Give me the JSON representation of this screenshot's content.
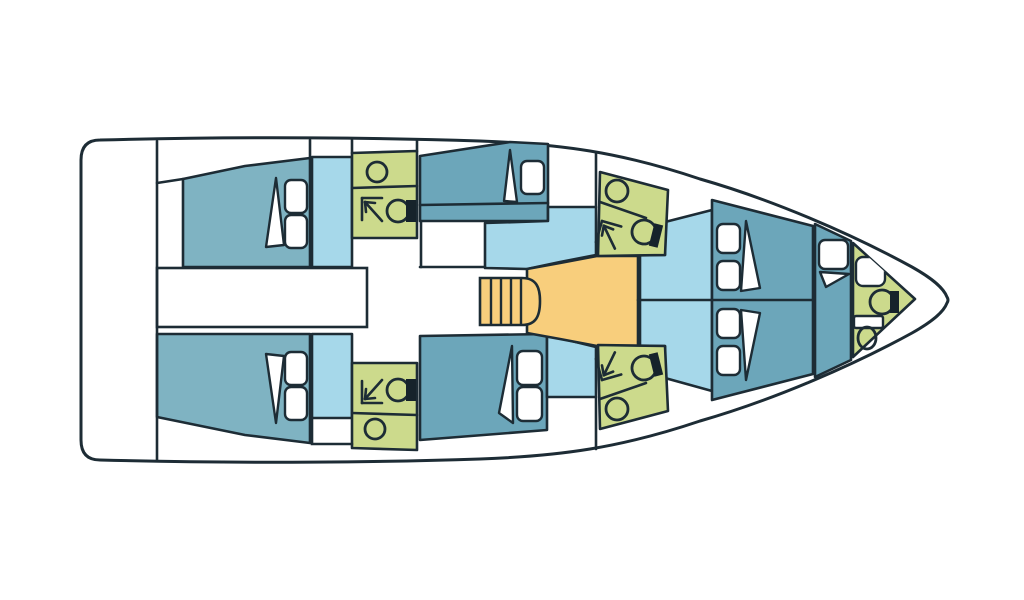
{
  "meta": {
    "canvas": {
      "width": 1024,
      "height": 600
    },
    "background": "#ffffff"
  },
  "palette": {
    "outline": "#1d2c35",
    "hull": "#ffffff",
    "cabin": "#7fb3c2",
    "berth": "#6ca6ba",
    "salon": "#a6d8ea",
    "bath": "#ccda8c",
    "galley": "#f8ce7c",
    "white": "#ffffff",
    "tank": "#16232b"
  },
  "style": {
    "hull_stroke": 3,
    "region_stroke": 2.6,
    "line_stroke": 2.6,
    "furniture_stroke": 2.4,
    "icon_stroke": 2.8,
    "pillow_radius": 6
  },
  "hull": {
    "path": "M100,140 C250,136 390,138 480,141 C560,144 620,152 700,179 C770,199 850,233 912,267 C935,280 944,289 947,297 Q949,300 947,303 C944,311 935,320 912,333 C850,367 770,401 700,421 C620,448 560,456 480,459 C390,462 250,464 100,460 Q81,460 81,440 L81,160 Q81,140 100,140 Z"
  },
  "regions": [
    {
      "name": "aft-cabin-port",
      "fill": "cabin",
      "points": [
        [
          183,
          179
        ],
        [
          245,
          166
        ],
        [
          310,
          158
        ],
        [
          310,
          267
        ],
        [
          183,
          267
        ]
      ]
    },
    {
      "name": "aft-cabin-starboard",
      "fill": "cabin",
      "points": [
        [
          157,
          334
        ],
        [
          310,
          334
        ],
        [
          310,
          443
        ],
        [
          245,
          435
        ],
        [
          157,
          417
        ]
      ]
    },
    {
      "name": "passage-port",
      "fill": "salon",
      "points": [
        [
          312,
          157
        ],
        [
          352,
          157
        ],
        [
          352,
          267
        ],
        [
          312,
          267
        ]
      ]
    },
    {
      "name": "passage-starboard",
      "fill": "salon",
      "points": [
        [
          312,
          334
        ],
        [
          352,
          334
        ],
        [
          352,
          418
        ],
        [
          312,
          418
        ]
      ]
    },
    {
      "name": "head-aft-port",
      "fill": "bath",
      "points": [
        [
          352,
          153
        ],
        [
          417,
          151
        ],
        [
          417,
          238
        ],
        [
          352,
          238
        ]
      ]
    },
    {
      "name": "head-aft-starboard",
      "fill": "bath",
      "points": [
        [
          352,
          363
        ],
        [
          417,
          363
        ],
        [
          417,
          450
        ],
        [
          352,
          448
        ]
      ]
    },
    {
      "name": "mid-cabin-port-berth",
      "fill": "berth",
      "points": [
        [
          420,
          156
        ],
        [
          510,
          142
        ],
        [
          548,
          144
        ],
        [
          548,
          221
        ],
        [
          420,
          221
        ]
      ]
    },
    {
      "name": "mid-cabin-starboard-berth",
      "fill": "berth",
      "points": [
        [
          420,
          336
        ],
        [
          547,
          334
        ],
        [
          547,
          430
        ],
        [
          420,
          440
        ]
      ]
    },
    {
      "name": "saloon-port",
      "fill": "salon",
      "points": [
        [
          485,
          223
        ],
        [
          548,
          221
        ],
        [
          548,
          207
        ],
        [
          596,
          207
        ],
        [
          596,
          255
        ],
        [
          560,
          262
        ],
        [
          527,
          269
        ],
        [
          485,
          268
        ]
      ]
    },
    {
      "name": "saloon-starboard",
      "fill": "salon",
      "points": [
        [
          547,
          335
        ],
        [
          596,
          347
        ],
        [
          596,
          397
        ],
        [
          547,
          397
        ]
      ]
    },
    {
      "name": "galley",
      "fill": "galley",
      "points": [
        [
          527,
          269
        ],
        [
          560,
          263
        ],
        [
          597,
          256
        ],
        [
          638,
          256
        ],
        [
          638,
          346
        ],
        [
          597,
          346
        ],
        [
          560,
          339
        ],
        [
          527,
          333
        ]
      ]
    },
    {
      "name": "saloon-forward",
      "fill": "salon",
      "points": [
        [
          640,
          255
        ],
        [
          665,
          255
        ],
        [
          665,
          222
        ],
        [
          712,
          210
        ],
        [
          712,
          391
        ],
        [
          665,
          378
        ],
        [
          665,
          346
        ],
        [
          640,
          346
        ]
      ]
    },
    {
      "name": "head-mid-port",
      "fill": "bath",
      "points": [
        [
          600,
          172
        ],
        [
          668,
          190
        ],
        [
          665,
          255
        ],
        [
          598,
          256
        ]
      ]
    },
    {
      "name": "head-mid-starboard",
      "fill": "bath",
      "points": [
        [
          600,
          429
        ],
        [
          668,
          411
        ],
        [
          665,
          346
        ],
        [
          598,
          345
        ]
      ]
    },
    {
      "name": "forward-cabin",
      "fill": "berth",
      "points": [
        [
          712,
          200
        ],
        [
          813,
          226
        ],
        [
          813,
          374
        ],
        [
          712,
          400
        ]
      ]
    },
    {
      "name": "bow-berth",
      "fill": "berth",
      "points": [
        [
          815,
          224
        ],
        [
          851,
          241
        ],
        [
          851,
          360
        ],
        [
          815,
          377
        ]
      ]
    },
    {
      "name": "head-bow",
      "fill": "bath",
      "points": [
        [
          853,
          243
        ],
        [
          915,
          299
        ],
        [
          853,
          357
        ]
      ]
    }
  ],
  "corridor": {
    "name": "companionway-corridor",
    "x": 157,
    "y": 268,
    "width": 210,
    "height": 59
  },
  "walls": [
    {
      "name": "transom-bulkhead",
      "points": [
        [
          157,
          141
        ],
        [
          157,
          460
        ]
      ]
    },
    {
      "name": "aft-port-cabin-edge",
      "points": [
        [
          157,
          183
        ],
        [
          183,
          179
        ]
      ]
    },
    {
      "name": "wall-port-cabin",
      "points": [
        [
          310,
          140
        ],
        [
          310,
          158
        ]
      ]
    },
    {
      "name": "wall-head-aft-port-left",
      "points": [
        [
          352,
          140
        ],
        [
          352,
          153
        ]
      ]
    },
    {
      "name": "wall-head-aft-port-right",
      "points": [
        [
          417,
          140
        ],
        [
          417,
          151
        ]
      ]
    },
    {
      "name": "corridor-extension",
      "points": [
        [
          420,
          267
        ],
        [
          485,
          267
        ]
      ]
    },
    {
      "name": "wall-mid-port",
      "points": [
        [
          421,
          221
        ],
        [
          421,
          267
        ]
      ]
    },
    {
      "name": "wall-starboard-locker",
      "points": [
        [
          312,
          418
        ],
        [
          312,
          444
        ],
        [
          352,
          444
        ]
      ]
    },
    {
      "name": "wall-port-wardrobe",
      "points": [
        [
          596,
          153
        ],
        [
          596,
          207
        ]
      ]
    },
    {
      "name": "wall-starboard-wardrobe",
      "points": [
        [
          596,
          397
        ],
        [
          596,
          449
        ]
      ]
    },
    {
      "name": "berth-shelf-divider",
      "points": [
        [
          420,
          205
        ],
        [
          548,
          203
        ]
      ]
    },
    {
      "name": "saloon-centerline",
      "points": [
        [
          638,
          300
        ],
        [
          813,
          300
        ]
      ]
    },
    {
      "name": "head-aft-port-divider",
      "points": [
        [
          352,
          188
        ],
        [
          417,
          186
        ]
      ]
    },
    {
      "name": "head-aft-starboard-divider",
      "points": [
        [
          352,
          413
        ],
        [
          417,
          415
        ]
      ]
    },
    {
      "name": "head-mid-port-divider",
      "points": [
        [
          600,
          202
        ],
        [
          646,
          218
        ]
      ]
    },
    {
      "name": "head-mid-starboard-divider",
      "points": [
        [
          600,
          399
        ],
        [
          646,
          383
        ]
      ]
    }
  ],
  "stairs": {
    "name": "companionway-stairs",
    "path": "M480,278 L522,278 C536,278 540,287 540,301 C540,316 536,325 522,325 L480,325 Z",
    "treads": [
      [
        491,
        279,
        491,
        324
      ],
      [
        501,
        279,
        501,
        324
      ],
      [
        511,
        279,
        511,
        324
      ],
      [
        521,
        279,
        521,
        324
      ]
    ]
  },
  "furniture": {
    "pillows": [
      {
        "name": "pillow",
        "x": 285,
        "y": 180,
        "w": 22,
        "h": 33
      },
      {
        "name": "pillow",
        "x": 285,
        "y": 215,
        "w": 22,
        "h": 33
      },
      {
        "name": "pillow",
        "x": 285,
        "y": 352,
        "w": 22,
        "h": 33
      },
      {
        "name": "pillow",
        "x": 285,
        "y": 387,
        "w": 22,
        "h": 33
      },
      {
        "name": "pillow",
        "x": 521,
        "y": 161,
        "w": 23,
        "h": 33
      },
      {
        "name": "pillow",
        "x": 517,
        "y": 351,
        "w": 25,
        "h": 34
      },
      {
        "name": "pillow",
        "x": 517,
        "y": 387,
        "w": 25,
        "h": 34
      },
      {
        "name": "pillow",
        "x": 717,
        "y": 224,
        "w": 23,
        "h": 29
      },
      {
        "name": "pillow",
        "x": 717,
        "y": 261,
        "w": 23,
        "h": 29
      },
      {
        "name": "pillow",
        "x": 717,
        "y": 309,
        "w": 23,
        "h": 29
      },
      {
        "name": "pillow",
        "x": 717,
        "y": 346,
        "w": 23,
        "h": 29
      },
      {
        "name": "pillow",
        "x": 819,
        "y": 240,
        "w": 29,
        "h": 29
      }
    ],
    "blankets": [
      {
        "name": "blanket-fold",
        "points": [
          [
            276,
            178
          ],
          [
            266,
            247
          ],
          [
            284,
            245
          ]
        ]
      },
      {
        "name": "blanket-fold",
        "points": [
          [
            276,
            423
          ],
          [
            266,
            354
          ],
          [
            284,
            356
          ]
        ]
      },
      {
        "name": "blanket-fold",
        "points": [
          [
            510,
            150
          ],
          [
            504,
            201
          ],
          [
            517,
            202
          ]
        ]
      },
      {
        "name": "blanket-fold",
        "points": [
          [
            512,
            346
          ],
          [
            499,
            413
          ],
          [
            513,
            423
          ]
        ]
      },
      {
        "name": "blanket-fold",
        "points": [
          [
            746,
            221
          ],
          [
            741,
            291
          ],
          [
            760,
            288
          ]
        ]
      },
      {
        "name": "blanket-fold",
        "points": [
          [
            746,
            380
          ],
          [
            741,
            310
          ],
          [
            760,
            313
          ]
        ]
      },
      {
        "name": "blanket-fold",
        "points": [
          [
            820,
            272
          ],
          [
            849,
            274
          ],
          [
            826,
            287
          ]
        ]
      }
    ],
    "sinks": [
      {
        "name": "sink",
        "cx": 377,
        "cy": 172,
        "rx": 10,
        "ry": 10
      },
      {
        "name": "sink",
        "cx": 375,
        "cy": 429,
        "rx": 10,
        "ry": 10
      },
      {
        "name": "sink",
        "cx": 617,
        "cy": 191,
        "rx": 11,
        "ry": 11
      },
      {
        "name": "sink",
        "cx": 617,
        "cy": 409,
        "rx": 11,
        "ry": 11
      },
      {
        "name": "sink",
        "cx": 867,
        "cy": 338,
        "rx": 9,
        "ry": 11
      }
    ],
    "toilets": [
      {
        "name": "toilet",
        "cx": 398,
        "cy": 211,
        "r": 11,
        "tank": [
          406,
          200,
          10,
          22
        ],
        "rotate": 0
      },
      {
        "name": "toilet",
        "cx": 398,
        "cy": 390,
        "r": 11,
        "tank": [
          406,
          379,
          10,
          22
        ],
        "rotate": 0
      },
      {
        "name": "toilet",
        "cx": 644,
        "cy": 232,
        "r": 12,
        "tank": [
          652,
          221,
          9,
          23
        ],
        "rotate": 14
      },
      {
        "name": "toilet",
        "cx": 644,
        "cy": 368,
        "r": 12,
        "tank": [
          652,
          356,
          9,
          23
        ],
        "rotate": -14
      },
      {
        "name": "toilet",
        "cx": 882,
        "cy": 302,
        "r": 12,
        "tank": [
          890,
          291,
          9,
          22
        ],
        "rotate": 0
      }
    ],
    "showers": [
      {
        "name": "shower-arrow",
        "x": 362,
        "y": 198,
        "flip": false,
        "rotate": 0
      },
      {
        "name": "shower-arrow",
        "x": 362,
        "y": 403,
        "flip": true,
        "rotate": 0
      },
      {
        "name": "shower-arrow",
        "x": 602,
        "y": 221,
        "flip": false,
        "rotate": 16
      },
      {
        "name": "shower-arrow",
        "x": 602,
        "y": 380,
        "flip": true,
        "rotate": 16
      }
    ],
    "panels": [
      {
        "name": "shower-pan",
        "x": 856,
        "y": 257,
        "w": 29,
        "h": 29,
        "rx": 7
      },
      {
        "name": "locker-panel",
        "x": 854,
        "y": 316,
        "w": 29,
        "h": 12,
        "rx": 2
      }
    ]
  },
  "shower_icon": {
    "segments": [
      [
        [
          0,
          0
        ],
        [
          20,
          0
        ]
      ],
      [
        [
          0,
          0
        ],
        [
          0,
          22
        ]
      ],
      [
        [
          20,
          23
        ],
        [
          3,
          4
        ]
      ],
      [
        [
          3,
          4
        ],
        [
          13,
          5
        ]
      ],
      [
        [
          3,
          4
        ],
        [
          4,
          14
        ]
      ]
    ]
  }
}
